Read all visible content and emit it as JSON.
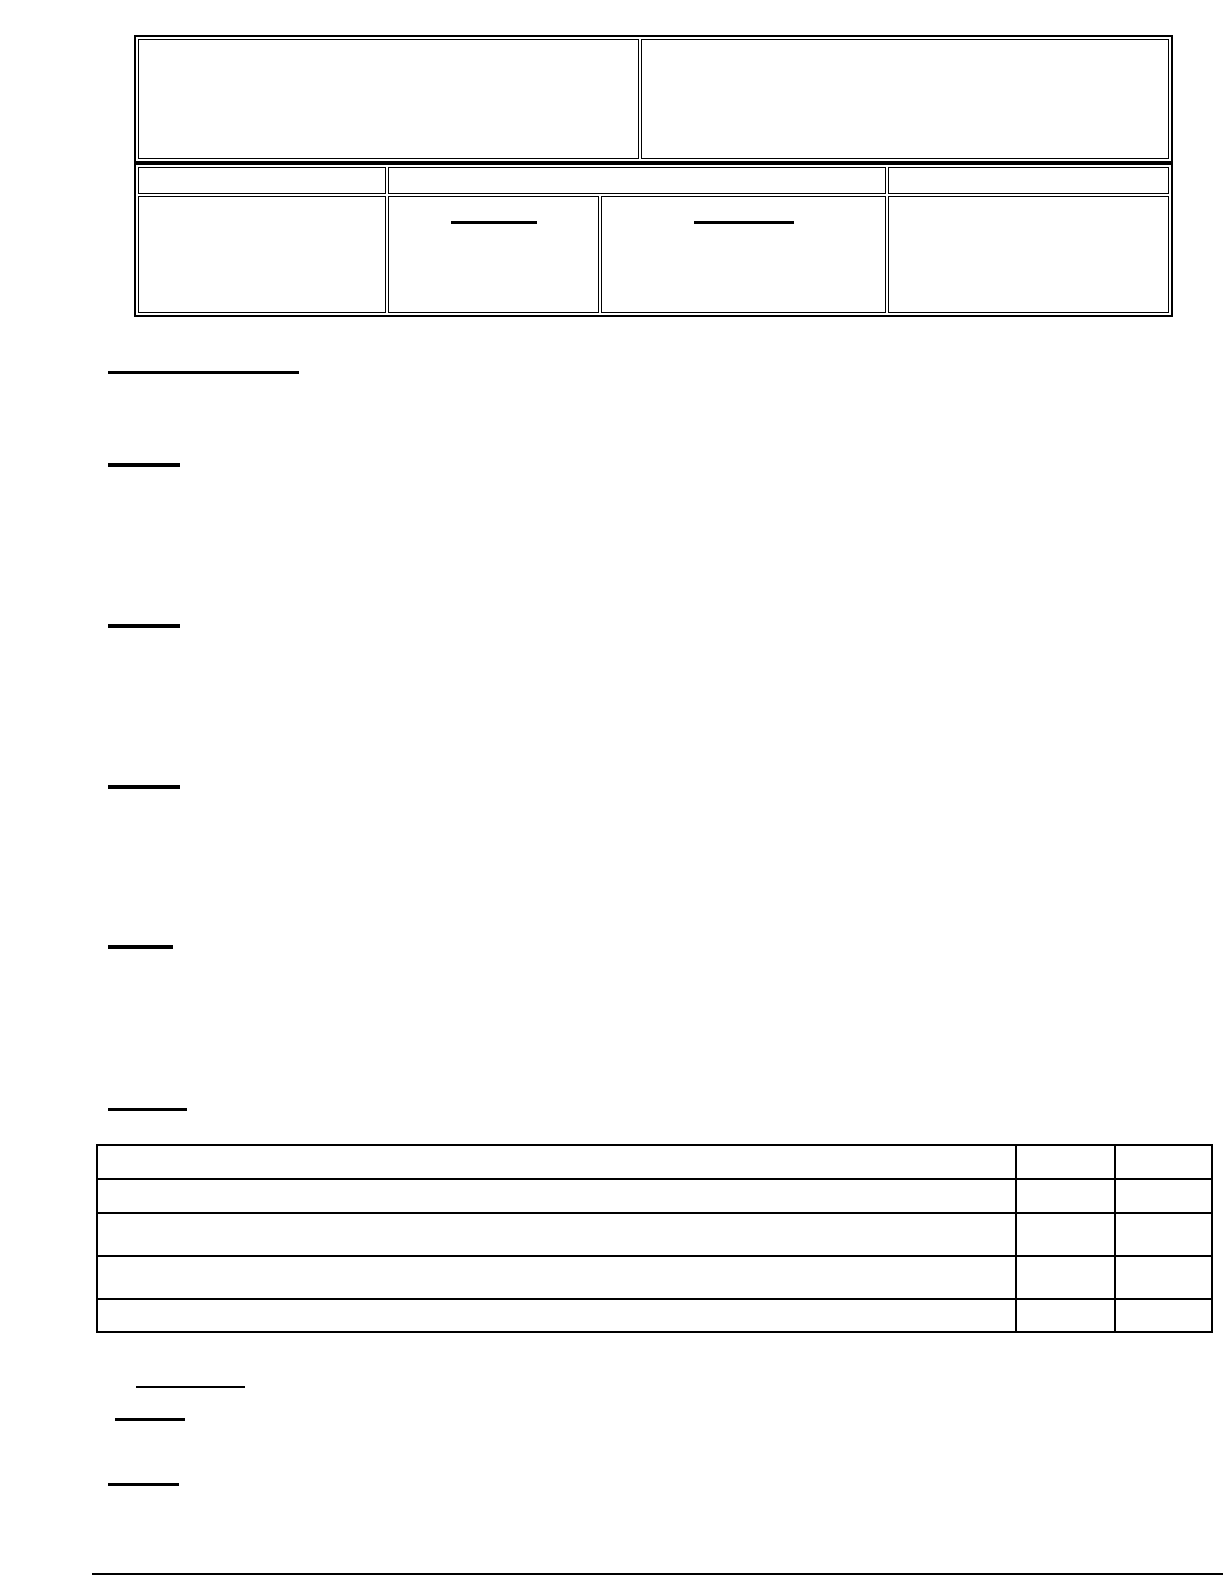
{
  "colors": {
    "background": "#ffffff",
    "line": "#000000"
  },
  "top_table": {
    "rows": 1,
    "columns": 2,
    "cells": [
      "",
      ""
    ]
  },
  "info_table": {
    "header_columns": 3,
    "header_cells": [
      "",
      "",
      ""
    ],
    "body_columns": 4,
    "body_cells": [
      "",
      "",
      "",
      ""
    ],
    "body_blank_underlines": 2
  },
  "section_underlines": {
    "count": 6
  },
  "checklist_table": {
    "rows": 5,
    "columns": 3,
    "answer_columns": 2,
    "cells_text": ""
  },
  "bottom_underlines": {
    "count": 3
  },
  "footer_rule": {
    "present": true
  }
}
